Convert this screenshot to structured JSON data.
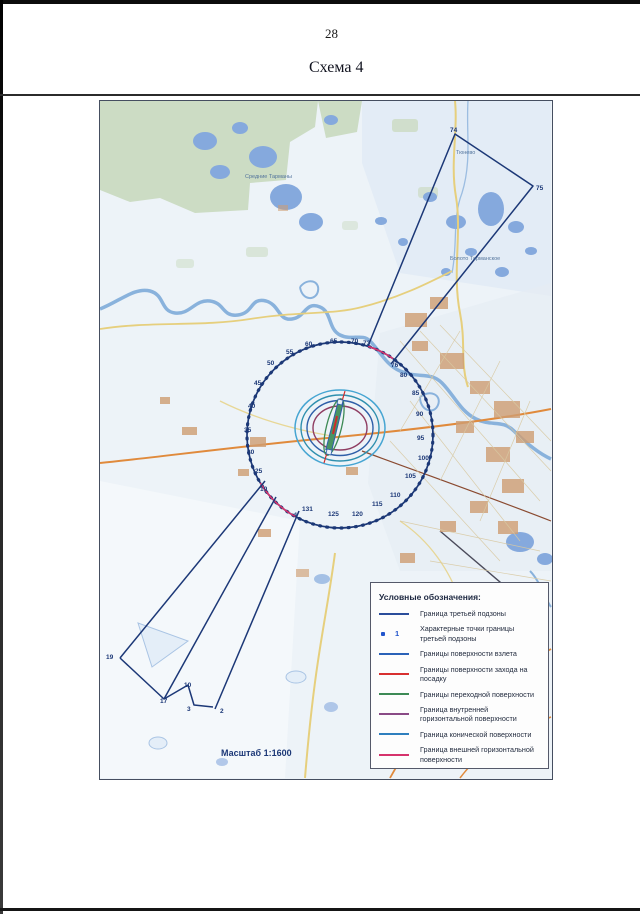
{
  "page": {
    "number": "28",
    "title": "Схема 4"
  },
  "map": {
    "scale_label": "Масштаб 1:1600",
    "place_labels": [
      {
        "text": "Средние Тарманы",
        "x": 145,
        "y": 77
      },
      {
        "text": "Болото Тарманское",
        "x": 350,
        "y": 159
      },
      {
        "text": "Тюнево",
        "x": 356,
        "y": 53
      }
    ],
    "points": [
      {
        "n": "1",
        "x": 194,
        "y": 416
      },
      {
        "n": "19",
        "x": 160,
        "y": 390
      },
      {
        "n": "25",
        "x": 155,
        "y": 372
      },
      {
        "n": "30",
        "x": 147,
        "y": 353
      },
      {
        "n": "35",
        "x": 144,
        "y": 331
      },
      {
        "n": "40",
        "x": 148,
        "y": 307
      },
      {
        "n": "45",
        "x": 154,
        "y": 284
      },
      {
        "n": "50",
        "x": 167,
        "y": 264
      },
      {
        "n": "55",
        "x": 186,
        "y": 253
      },
      {
        "n": "60",
        "x": 205,
        "y": 245
      },
      {
        "n": "65",
        "x": 230,
        "y": 242
      },
      {
        "n": "70",
        "x": 251,
        "y": 242
      },
      {
        "n": "73",
        "x": 263,
        "y": 244
      },
      {
        "n": "76",
        "x": 291,
        "y": 266
      },
      {
        "n": "80",
        "x": 300,
        "y": 276
      },
      {
        "n": "85",
        "x": 312,
        "y": 294
      },
      {
        "n": "90",
        "x": 316,
        "y": 315
      },
      {
        "n": "95",
        "x": 317,
        "y": 339
      },
      {
        "n": "100",
        "x": 318,
        "y": 359
      },
      {
        "n": "105",
        "x": 305,
        "y": 377
      },
      {
        "n": "110",
        "x": 290,
        "y": 396
      },
      {
        "n": "115",
        "x": 272,
        "y": 405
      },
      {
        "n": "120",
        "x": 252,
        "y": 415
      },
      {
        "n": "125",
        "x": 228,
        "y": 415
      },
      {
        "n": "131",
        "x": 202,
        "y": 410
      },
      {
        "n": "74",
        "x": 350,
        "y": 31
      },
      {
        "n": "75",
        "x": 436,
        "y": 89
      },
      {
        "n": "19",
        "x": 6,
        "y": 558
      },
      {
        "n": "17",
        "x": 60,
        "y": 602
      },
      {
        "n": "10",
        "x": 84,
        "y": 586
      },
      {
        "n": "3",
        "x": 87,
        "y": 610
      },
      {
        "n": "2",
        "x": 120,
        "y": 612
      }
    ]
  },
  "legend": {
    "title": "Условные обозначения:",
    "items": [
      {
        "type": "line",
        "color": "#2b4d9b",
        "label": "Граница третьей подзоны"
      },
      {
        "type": "point",
        "color": "#2255cc",
        "num": "1",
        "label": "Характерные точки границы третьей подзоны"
      },
      {
        "type": "line",
        "color": "#2b62b8",
        "label": "Границы поверхности взлета"
      },
      {
        "type": "line",
        "color": "#d83030",
        "label": "Границы поверхности захода на посадку"
      },
      {
        "type": "line",
        "color": "#3d8a55",
        "label": "Границы переходной поверхности"
      },
      {
        "type": "line",
        "color": "#8a4a86",
        "label": "Граница внутренней горизонтальной поверхности"
      },
      {
        "type": "line",
        "color": "#2e7fbe",
        "label": "Граница конической поверхности"
      },
      {
        "type": "line",
        "color": "#d6336c",
        "label": "Граница внешней горизонтальной поверхности"
      }
    ]
  },
  "colors": {
    "subzone_navy": "#1c3877",
    "approach_red": "#cf2b2b",
    "transitional_green": "#3d8a55",
    "inner_horizontal_purple": "#8f3d62",
    "conical_blue": "#2e8fae",
    "outer_horizontal_pink": "#d6336c"
  }
}
